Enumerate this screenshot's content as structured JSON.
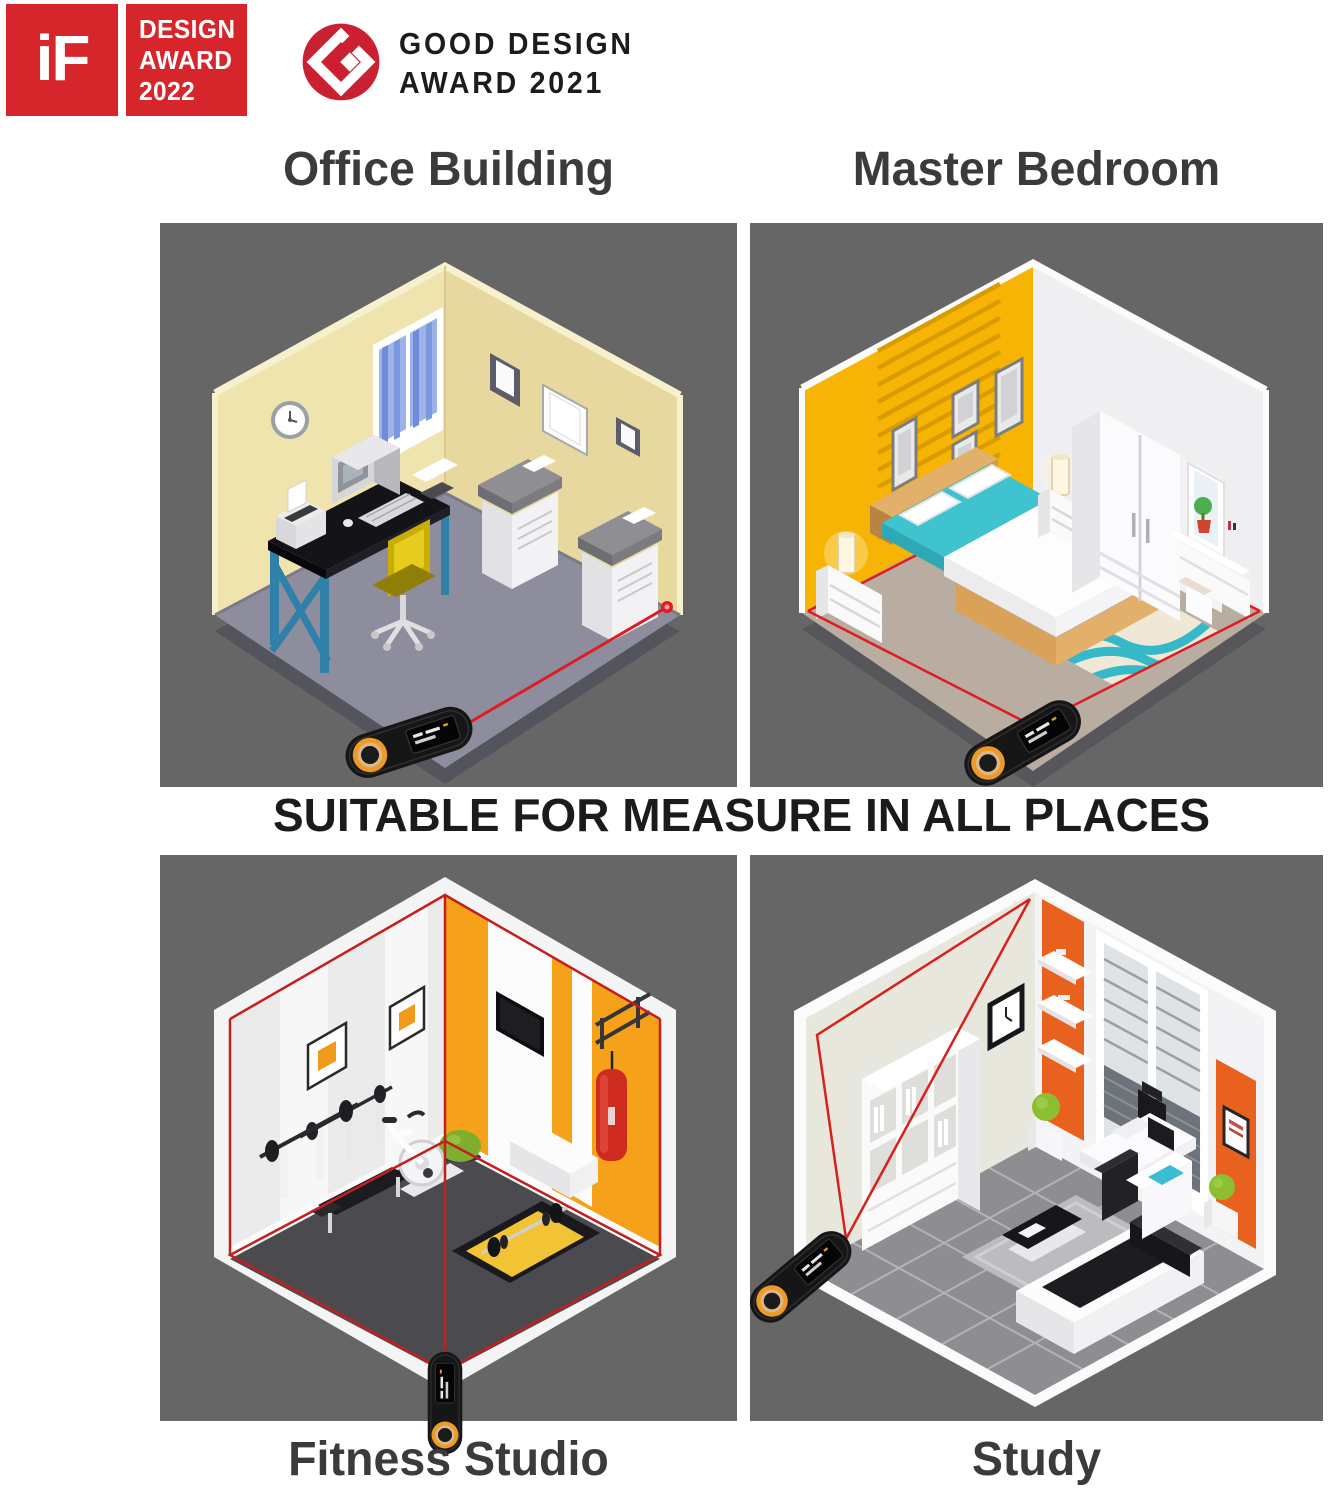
{
  "page": {
    "width": 1330,
    "height": 1498,
    "background": "#ffffff"
  },
  "badges": {
    "if_design_award": {
      "logo_text": "iF",
      "lines": [
        "DESIGN",
        "AWARD",
        "2022"
      ],
      "bg_color": "#d6252b",
      "text_color": "#ffffff"
    },
    "good_design_award": {
      "logo": "g-mark-logo",
      "lines": [
        "GOOD DESIGN",
        "AWARD 2021"
      ],
      "logo_color": "#ca2031",
      "text_color": "#1c1c1e"
    }
  },
  "headline": "SUITABLE FOR MEASURE IN ALL PLACES",
  "panels": [
    {
      "id": "office-building",
      "title": "Office Building"
    },
    {
      "id": "master-bedroom",
      "title": "Master Bedroom"
    },
    {
      "id": "fitness-studio",
      "title": "Fitness Studio"
    },
    {
      "id": "study",
      "title": "Study"
    }
  ],
  "device": {
    "name": "laser distance measure",
    "body_color": "#161616",
    "ring_color": "#ef9a28",
    "laser_color": "#e01b24"
  },
  "palette": {
    "panel_background": "#666666",
    "title_text": "#3b3b3b",
    "headline_text": "#1b1b1b",
    "office_wall": "#efe3ae",
    "office_floor": "#8d8d9e",
    "bedroom_accent_wall": "#f8b404",
    "bedroom_floor": "#b9aca0",
    "fitness_accent_wall": "#f6a11a",
    "fitness_floor": "#4b4b4f",
    "study_accent_panel": "#e8611f",
    "study_floor": "#8e8e92",
    "teal": "#3fc3cf"
  }
}
